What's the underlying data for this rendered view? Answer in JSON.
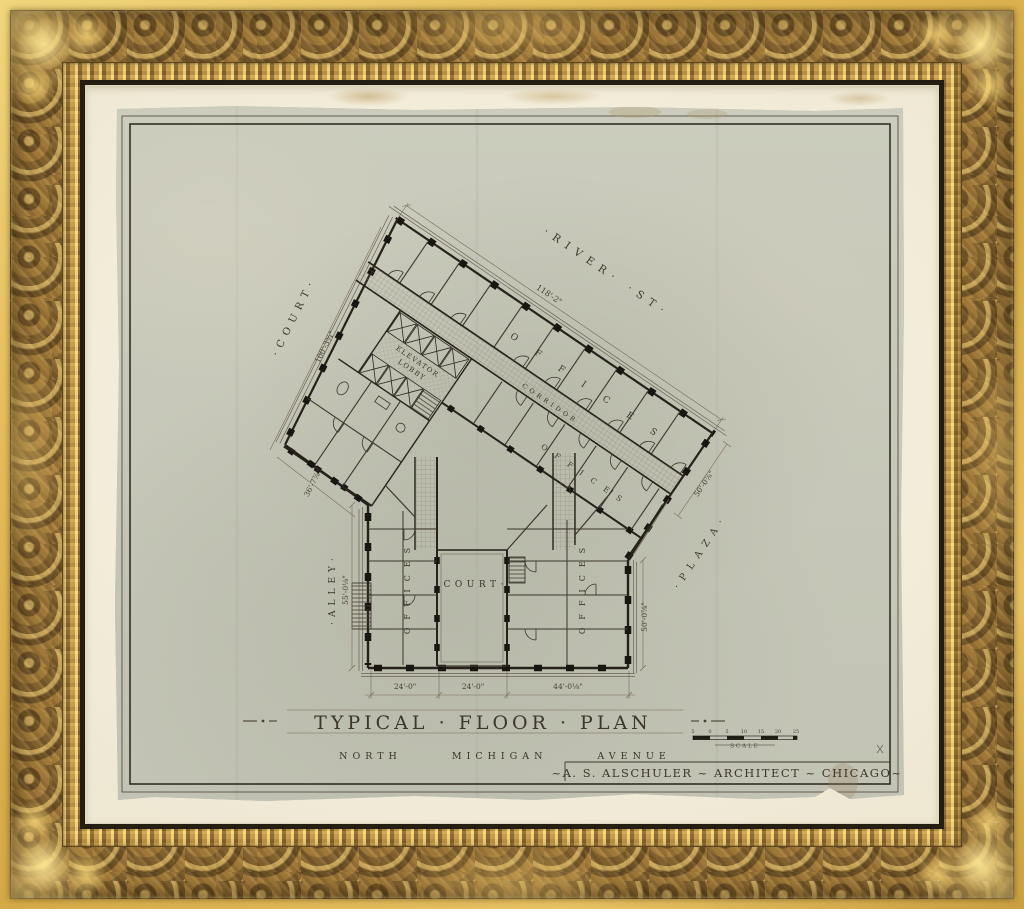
{
  "titleblock": {
    "title": "TYPICAL · FLOOR · PLAN",
    "subtitle": "NORTH MICHIGAN AVENUE",
    "architect": "~A. S. ALSCHULER ~ ARCHITECT ~ CHICAGO~",
    "scale_label": "SCALE",
    "scale_ticks": [
      "5",
      "0",
      "5",
      "10",
      "15",
      "20",
      "25"
    ]
  },
  "site": {
    "street": "·RIVER· ·ST·",
    "court_nw": "·COURT·",
    "alley": "·ALLEY·",
    "plaza": "·PLAZA·",
    "court_center": "·COURT·"
  },
  "rooms": {
    "elevator_line1": "ELEVATOR",
    "elevator_line2": "LOBBY",
    "corridor": "CORRIDOR",
    "offices_a": "OFFICES",
    "offices_b": "OFFICES",
    "offices_left": "OFFICES",
    "offices_right": "OFFICES"
  },
  "dims": {
    "river_front": "118'-2\"",
    "court_side": "100'-3¾\"",
    "west_jog": "36'-7⅞\"",
    "plaza_ne": "50'-0⅞\"",
    "alley_side": "55'-0⅛\"",
    "plaza_se": "50'-0⅞\"",
    "bay_left": "24'-0\"",
    "bay_court": "24'-0\"",
    "bay_right": "44'-0⅛\""
  },
  "colors": {
    "frame_gold": "#b28a44",
    "mat": "#f2ecd9",
    "paper": "#c7c8b9",
    "ink": "#3d362b"
  }
}
